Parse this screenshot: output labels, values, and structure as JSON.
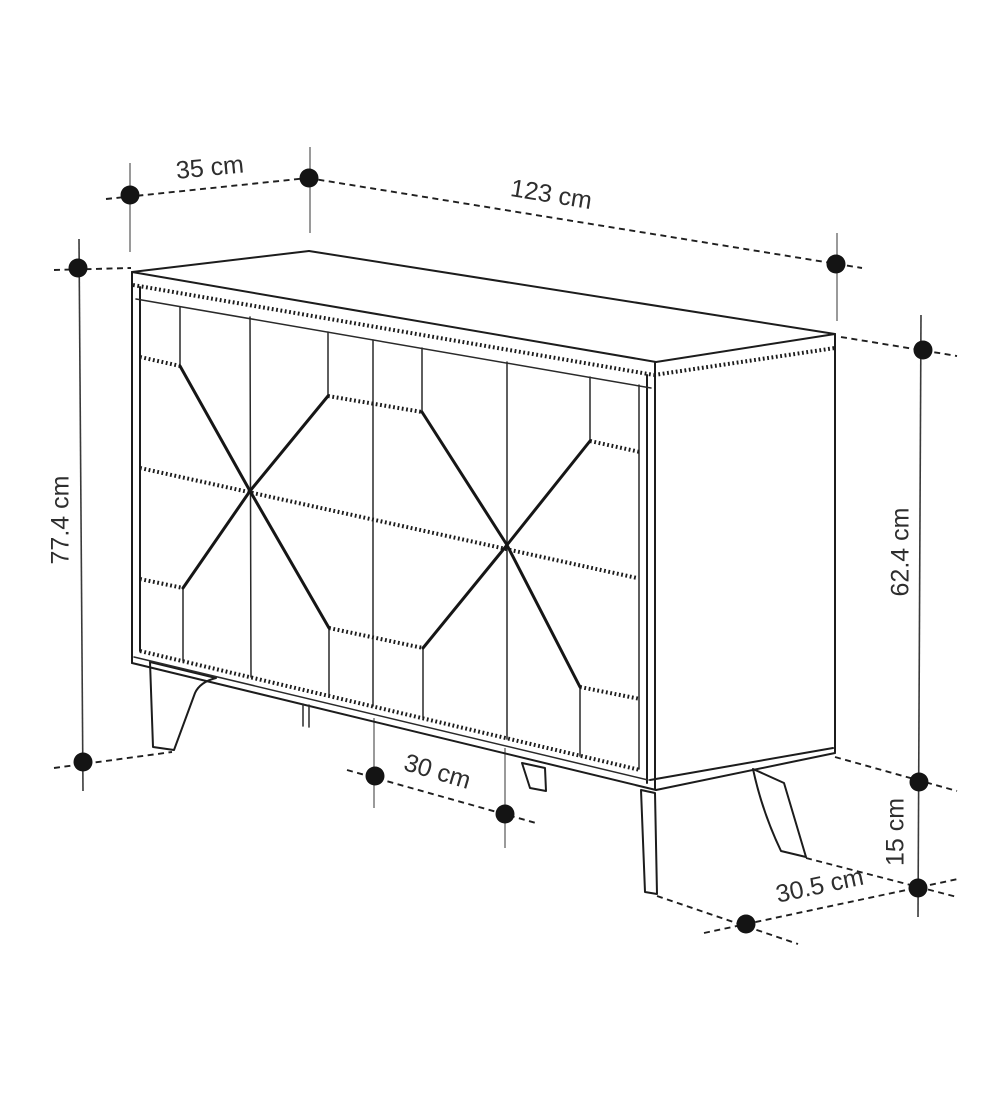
{
  "diagram": {
    "type": "furniture-dimension-diagram",
    "subject": "sideboard with geometric star-pattern doors and splayed legs",
    "unit": "cm",
    "colors": {
      "background": "#ffffff",
      "line": "#1c1c1c",
      "extension_line": "#6f6f6f",
      "dot": "#141414",
      "text": "#2e2e2e"
    },
    "dimensions": [
      {
        "id": "top-depth",
        "label": "35 cm",
        "value": 35,
        "x": 210,
        "y": 169,
        "rot": -5.5
      },
      {
        "id": "top-width",
        "label": "123 cm",
        "value": 123,
        "x": 551,
        "y": 196,
        "rot": 9.3
      },
      {
        "id": "total-height",
        "label": "77.4 cm",
        "value": 77.4,
        "x": 62,
        "y": 520,
        "rot": -90
      },
      {
        "id": "body-height",
        "label": "62.4 cm",
        "value": 62.4,
        "x": 902,
        "y": 552,
        "rot": -90
      },
      {
        "id": "leg-height",
        "label": "15 cm",
        "value": 15,
        "x": 897,
        "y": 832,
        "rot": -90
      },
      {
        "id": "front-leg-spacing",
        "label": "30 cm",
        "value": 30,
        "x": 437,
        "y": 773,
        "rot": 16.5
      },
      {
        "id": "side-leg-spacing",
        "label": "30.5 cm",
        "value": 30.5,
        "x": 820,
        "y": 887,
        "rot": -12
      }
    ],
    "geometry": {
      "outline": [
        [
          132,
          272,
          656,
          362
        ],
        [
          132,
          272,
          309,
          251
        ],
        [
          309,
          251,
          835,
          334
        ],
        [
          656,
          362,
          835,
          334
        ],
        [
          835,
          334,
          835,
          752
        ],
        [
          650,
          780,
          833,
          748
        ],
        [
          656,
          790,
          835,
          753
        ],
        [
          132,
          272,
          132,
          663
        ],
        [
          140,
          287,
          140,
          651
        ],
        [
          132,
          663,
          656,
          790
        ],
        [
          647,
          375,
          647,
          783
        ],
        [
          655,
          363,
          655,
          789
        ]
      ],
      "thin_lines": [
        [
          136,
          299,
          651,
          388
        ],
        [
          134,
          657,
          648,
          780
        ],
        [
          639,
          385,
          639,
          769
        ],
        [
          250,
          317,
          251,
          677
        ],
        [
          373,
          340,
          373,
          706
        ],
        [
          507,
          362,
          507,
          739
        ],
        [
          180,
          307,
          180,
          366
        ],
        [
          328,
          332,
          328,
          396
        ],
        [
          422,
          348,
          422,
          412
        ],
        [
          590,
          377,
          590,
          441
        ],
        [
          183,
          588,
          183,
          661
        ],
        [
          329,
          628,
          329,
          696
        ],
        [
          423,
          648,
          423,
          718
        ],
        [
          580,
          687,
          580,
          756
        ],
        [
          303,
          704,
          303,
          726
        ],
        [
          309,
          705,
          309,
          727
        ]
      ],
      "hatched": [
        [
          133,
          285,
          654,
          375
        ],
        [
          654,
          375,
          835,
          348
        ],
        [
          140,
          468,
          637,
          578
        ],
        [
          140,
          651,
          640,
          770
        ],
        [
          140,
          357,
          180,
          366
        ],
        [
          328,
          396,
          422,
          412
        ],
        [
          590,
          441,
          640,
          452
        ],
        [
          140,
          579,
          183,
          588
        ],
        [
          329,
          628,
          423,
          648
        ],
        [
          580,
          687,
          640,
          699
        ]
      ],
      "rays": [
        [
          250,
          491,
          180,
          366
        ],
        [
          250,
          491,
          328,
          396
        ],
        [
          250,
          491,
          183,
          588
        ],
        [
          250,
          491,
          329,
          628
        ],
        [
          507,
          545,
          422,
          412
        ],
        [
          507,
          545,
          590,
          441
        ],
        [
          507,
          545,
          423,
          648
        ],
        [
          507,
          545,
          580,
          687
        ]
      ],
      "dashed": [
        [
          106,
          199,
          308,
          178
        ],
        [
          308,
          178,
          862,
          268
        ],
        [
          54,
          270,
          131,
          268
        ],
        [
          54,
          768,
          172,
          752
        ],
        [
          841,
          337,
          957,
          356
        ],
        [
          835,
          757,
          957,
          791
        ],
        [
          806,
          858,
          957,
          897
        ],
        [
          657,
          896,
          798,
          944
        ],
        [
          347,
          770,
          536,
          823
        ],
        [
          704,
          933,
          958,
          879
        ]
      ],
      "extension": [
        [
          130,
          163,
          130,
          252
        ],
        [
          310,
          147,
          310,
          233
        ],
        [
          837,
          233,
          837,
          321
        ],
        [
          374,
          718,
          374,
          808
        ],
        [
          505,
          748,
          505,
          848
        ]
      ],
      "dim_lines": [
        [
          79,
          239,
          83,
          791
        ],
        [
          921,
          315,
          918,
          917
        ]
      ],
      "legs": [
        "M150,662 L216,678 Q200,682 195,693 L174,750 L153,747 Z",
        "M522,763 L545,768 L546,791 L530,788 Z",
        "M641,790 L655,793 L657,894 L645,892 Z",
        "M753,769 L784,783 L806,857 L781,851 C769,826 759,797 753,769 Z"
      ],
      "dots": [
        [
          130,
          195
        ],
        [
          309,
          178
        ],
        [
          836,
          264
        ],
        [
          78,
          268
        ],
        [
          83,
          762
        ],
        [
          923,
          350
        ],
        [
          919,
          782
        ],
        [
          918,
          888
        ],
        [
          375,
          776
        ],
        [
          505,
          814
        ],
        [
          746,
          924
        ]
      ],
      "dot_radius": 9.5
    }
  }
}
